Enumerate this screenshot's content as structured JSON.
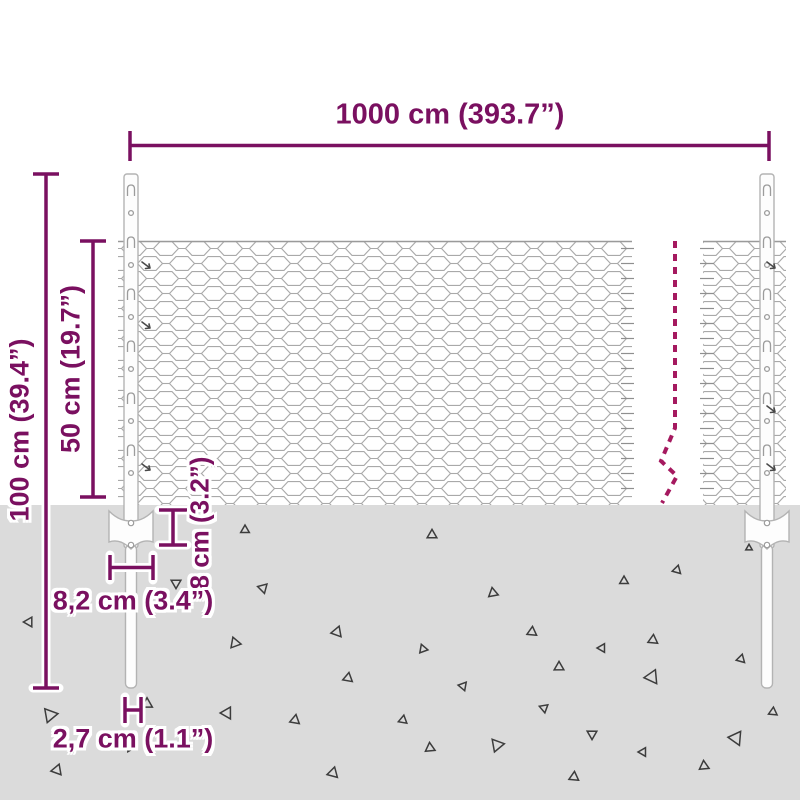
{
  "diagram": {
    "type": "product-dimension-diagram",
    "subject": "chain-link fence kit with U-posts, anchor clamps and ground stakes"
  },
  "labels": {
    "total_width": "1000 cm (393.7”)",
    "post_height": "100 cm (39.4”)",
    "mesh_height": "50 cm (19.7”)",
    "anchor_depth": "8 cm (3.2”)",
    "anchor_width": "8,2 cm (3.4”)",
    "post_diameter": "2,7 cm (1.1”)"
  },
  "colors": {
    "dimension": "#7a1060",
    "break_line": "#a5195f",
    "ground": "#dbdbdb",
    "mesh_stroke": "#a9a9a9",
    "post_stroke": "#b3b3b3",
    "triangle_stroke": "#3c3c3c",
    "background": "#ffffff"
  },
  "ground": {
    "triangles": [
      [
        245,
        530,
        8,
        0
      ],
      [
        263,
        588,
        9,
        45
      ],
      [
        176,
        583,
        9,
        180
      ],
      [
        29,
        622,
        9,
        150
      ],
      [
        337,
        632,
        10,
        20
      ],
      [
        235,
        643,
        10,
        100
      ],
      [
        348,
        678,
        9,
        10
      ],
      [
        50,
        715,
        13,
        200
      ],
      [
        147,
        704,
        10,
        120
      ],
      [
        227,
        713,
        11,
        30
      ],
      [
        295,
        720,
        9,
        130
      ],
      [
        57,
        770,
        10,
        140
      ],
      [
        333,
        773,
        10,
        135
      ],
      [
        130,
        748,
        7,
        210
      ],
      [
        432,
        535,
        9,
        0
      ],
      [
        493,
        593,
        9,
        110
      ],
      [
        624,
        581,
        8,
        120
      ],
      [
        677,
        570,
        8,
        15
      ],
      [
        532,
        632,
        9,
        125
      ],
      [
        602,
        648,
        8,
        30
      ],
      [
        653,
        640,
        9,
        5
      ],
      [
        423,
        649,
        8,
        100
      ],
      [
        559,
        667,
        9,
        120
      ],
      [
        463,
        686,
        8,
        160
      ],
      [
        741,
        659,
        8,
        15
      ],
      [
        652,
        677,
        13,
        25
      ],
      [
        544,
        708,
        8,
        170
      ],
      [
        403,
        720,
        8,
        10
      ],
      [
        592,
        734,
        9,
        60
      ],
      [
        430,
        748,
        9,
        115
      ],
      [
        497,
        745,
        12,
        200
      ],
      [
        643,
        752,
        8,
        150
      ],
      [
        736,
        738,
        13,
        35
      ],
      [
        773,
        712,
        8,
        5
      ],
      [
        704,
        766,
        9,
        115
      ],
      [
        574,
        777,
        9,
        125
      ],
      [
        749,
        548,
        6,
        0
      ]
    ]
  },
  "structure": {
    "mesh_rows_top_y": 241,
    "ground_top_y": 505,
    "post_top_y": 174,
    "stake_bottom_y": 688
  }
}
